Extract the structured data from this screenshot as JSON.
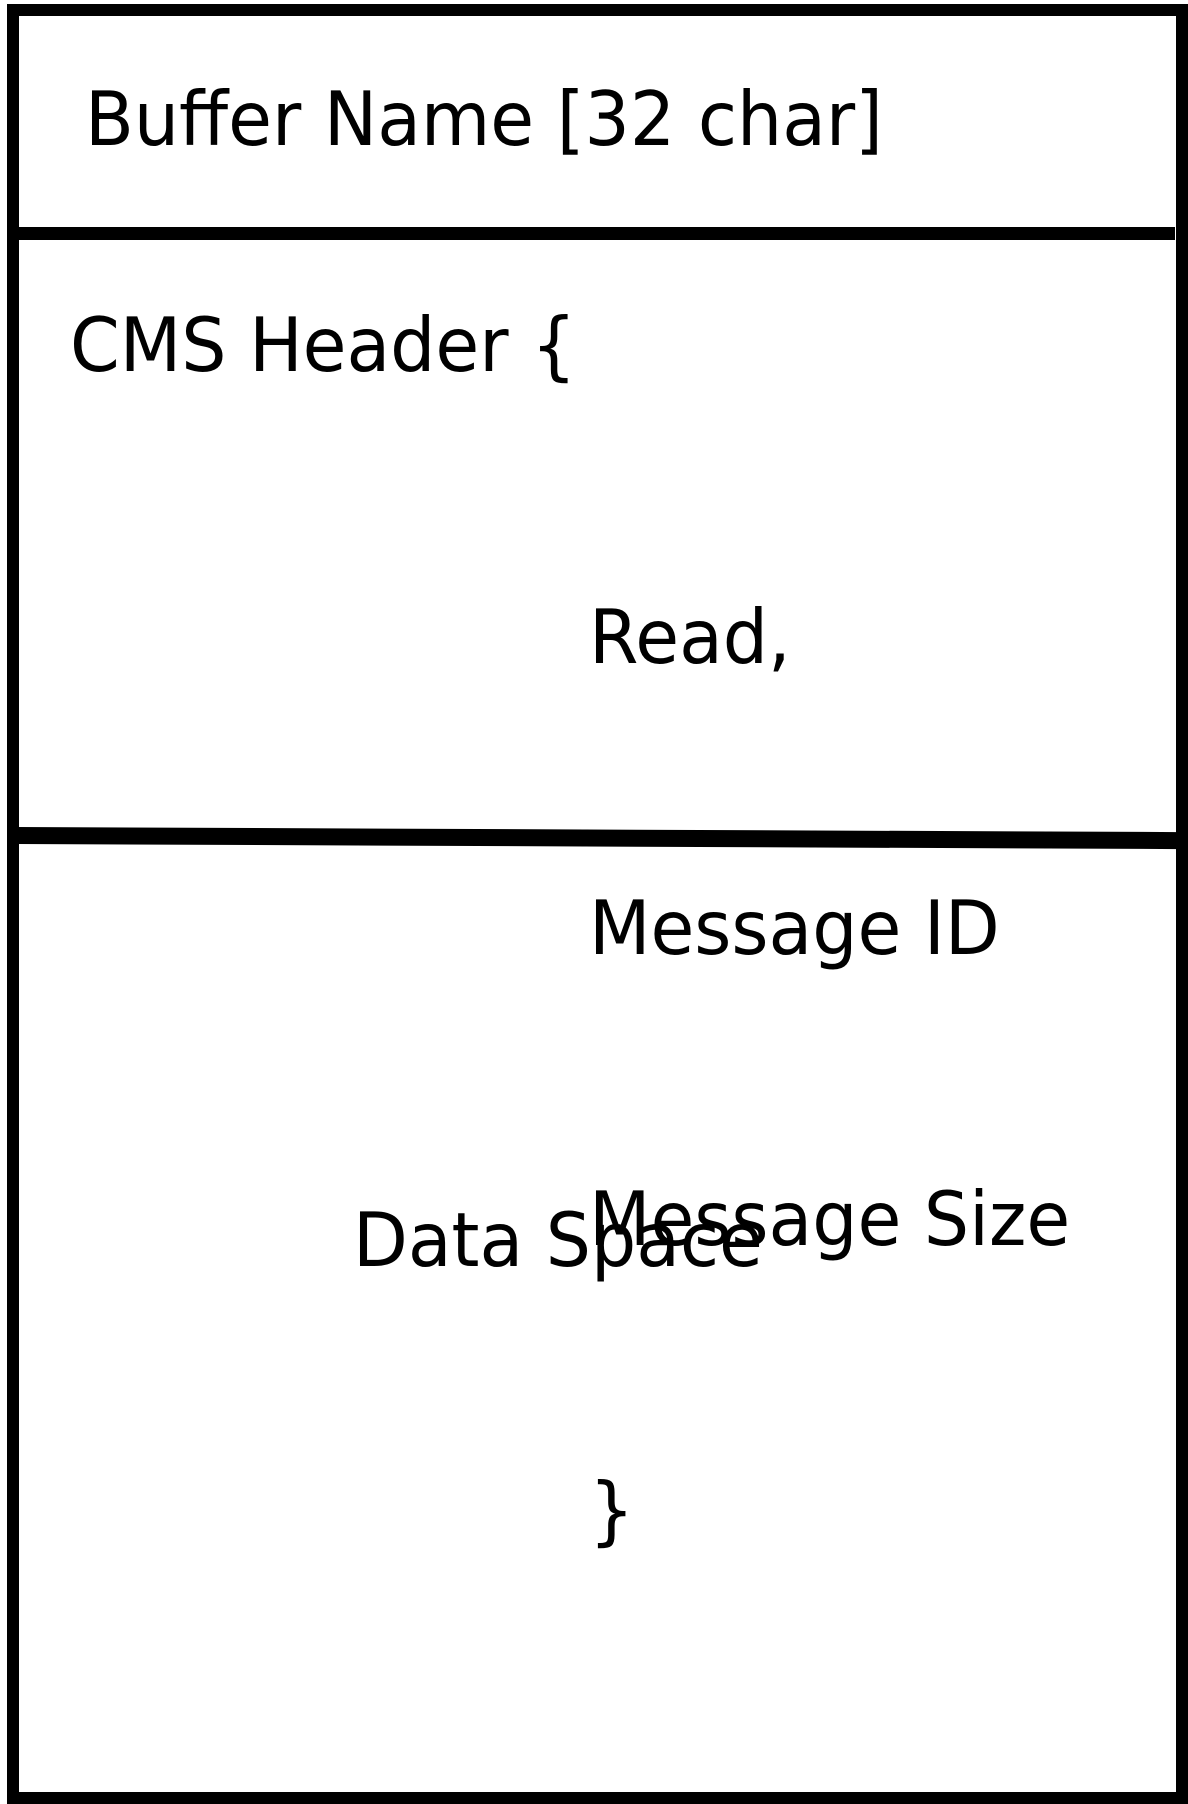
{
  "colors": {
    "background": "#ffffff",
    "frame": "#000000",
    "text": "#000000"
  },
  "buffer_diagram": {
    "name_section": {
      "label": "Buffer Name [32 char]"
    },
    "header_section": {
      "opening": "CMS Header {",
      "fields": [
        "Read,",
        "Message ID",
        "Message Size"
      ],
      "closing": "}"
    },
    "data_section": {
      "label": "Data Space"
    }
  }
}
